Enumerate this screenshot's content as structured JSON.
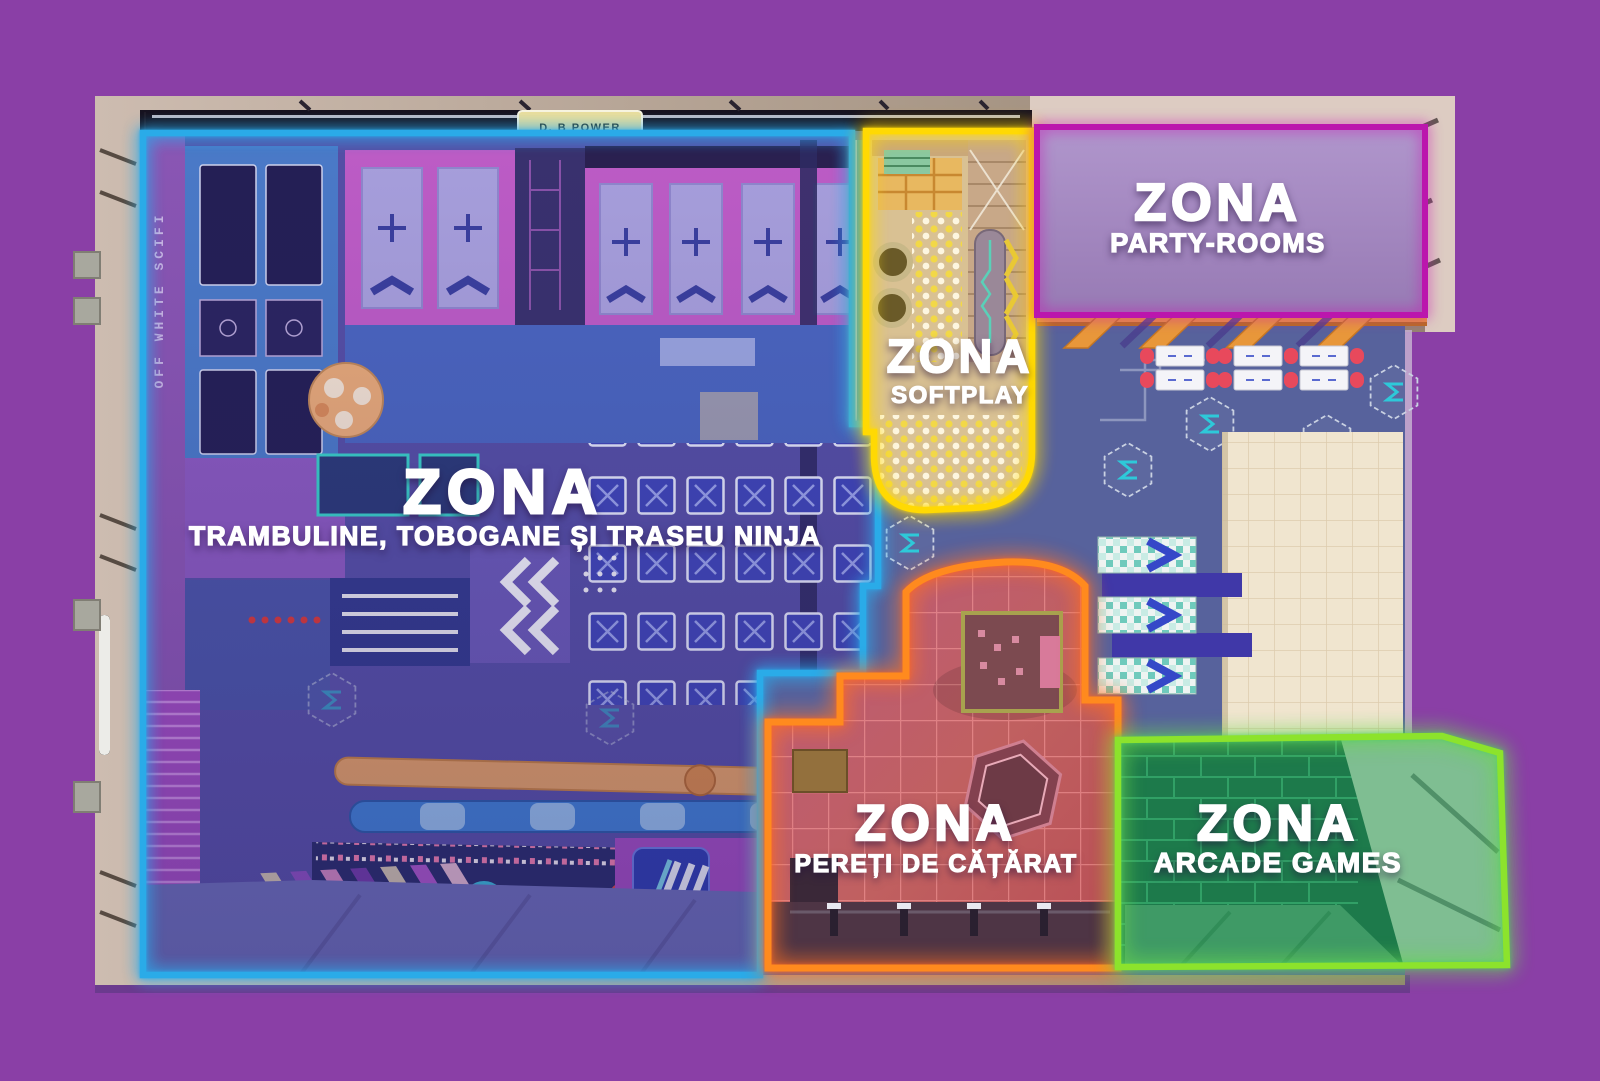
{
  "page": {
    "background_color": "#8a3fa6"
  },
  "building": {
    "power_sign_label": "D. B POWER",
    "side_wall_text": "OFF WHITE SCIFI"
  },
  "zones": [
    {
      "id": "trampoline-ninja",
      "title": "ZONA",
      "subtitle": "TRAMBULINE, TOBOGANE ȘI TRASEU NINJA",
      "outline_color": "#2aabe8"
    },
    {
      "id": "softplay",
      "title": "ZONA",
      "subtitle": "SOFTPLAY",
      "outline_color": "#ffd903"
    },
    {
      "id": "party-rooms",
      "title": "ZONA",
      "subtitle": "PARTY-ROOMS",
      "outline_color": "#bb16ad",
      "fill_color": "#a78cc4"
    },
    {
      "id": "climbing-walls",
      "title": "ZONA",
      "subtitle": "PEREȚI DE CĂȚĂRAT",
      "outline_color": "#ff8a1e"
    },
    {
      "id": "arcade-games",
      "title": "ZONA",
      "subtitle": "ARCADE GAMES",
      "outline_color": "#8ce32c",
      "fill_color": "#1d7a4b"
    }
  ]
}
